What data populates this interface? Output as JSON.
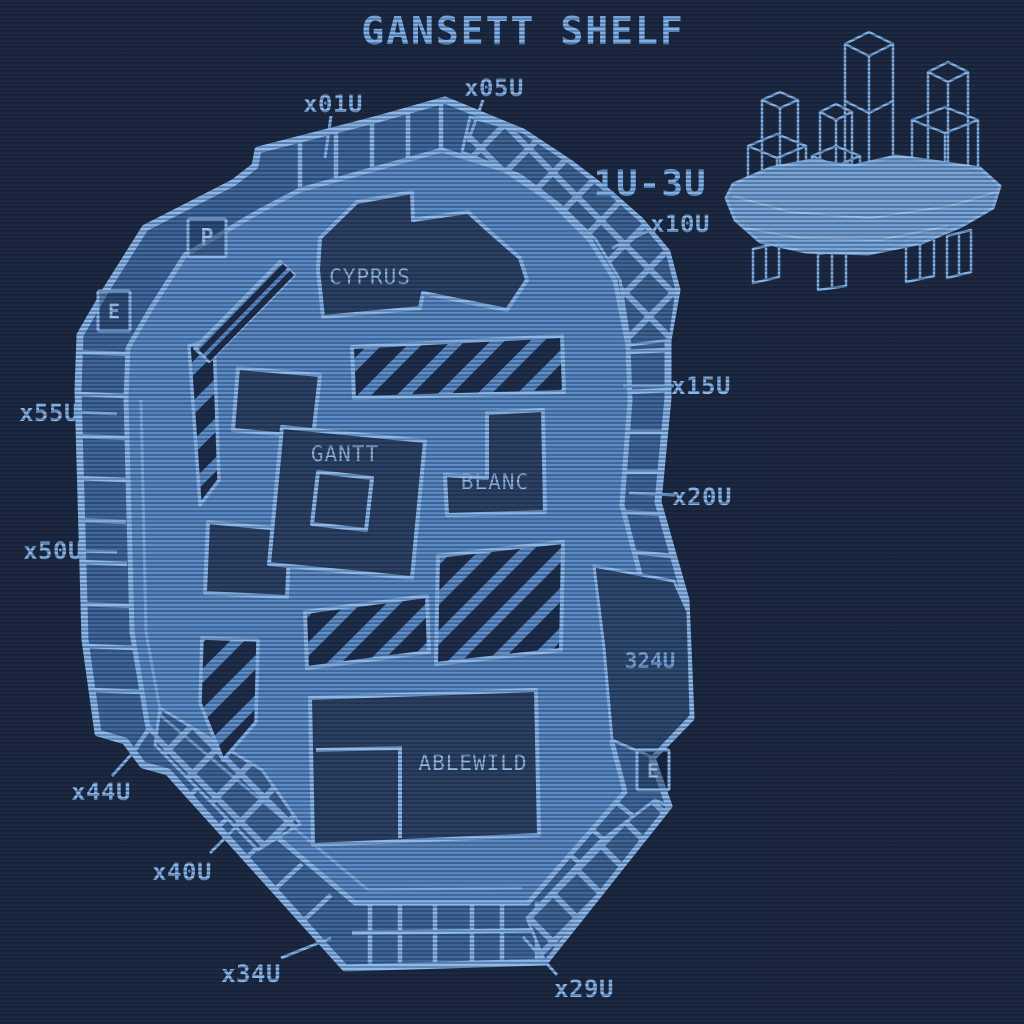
{
  "title": "GANSETT SHELF",
  "inset": {
    "range_label": "1U-3U"
  },
  "edge_labels": {
    "x01u": "x01U",
    "x05u": "x05U",
    "x10u": "x10U",
    "x15u": "x15U",
    "x20u": "x20U",
    "x29u": "x29U",
    "x34u": "x34U",
    "x40u": "x40U",
    "x44u": "x44U",
    "x50u": "x50U",
    "x55u": "x55U"
  },
  "zones": {
    "cyprus": "CYPRUS",
    "gantt": "GANTT",
    "blanc": "BLANC",
    "ablewild": "ABLEWILD",
    "berth_324": "324U"
  },
  "markers": {
    "parking": "P",
    "exit_upper": "E",
    "exit_lower": "E"
  },
  "colors": {
    "background": "#1c2940",
    "outline": "#8cbaee",
    "courtyard": "#5b8dca",
    "ring": "#3f689f",
    "zone_fill": "#2b4265",
    "hatch_dark": "#1e2e4a",
    "label": "#86b6ec"
  }
}
